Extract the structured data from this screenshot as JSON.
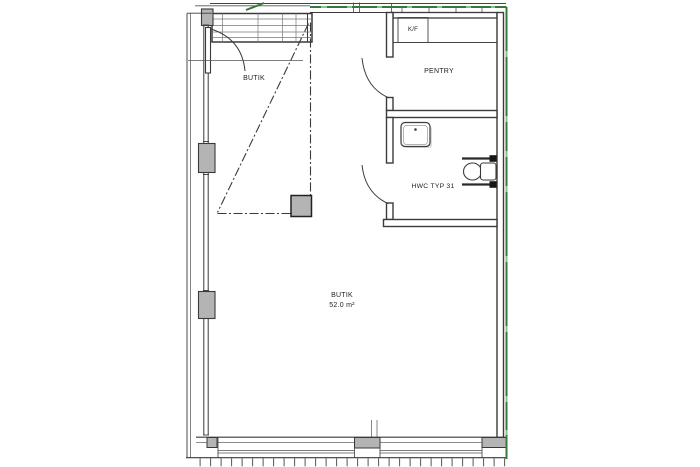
{
  "plan": {
    "type": "architectural-floor-plan",
    "entry_door_label": "BUTIK",
    "main_room": {
      "name": "BUTIK",
      "area": "52.0 m²"
    },
    "pentry": {
      "name": "PENTRY"
    },
    "hwc": {
      "name": "HWC TYP 31"
    },
    "appliance_label": "K/F",
    "colors": {
      "facade_green": "#357a38",
      "facade_green_light": "#8fc08b",
      "line_dark": "#3a3a3a",
      "line_light": "#6a6a6a",
      "fill_gray": "#b4b4b4"
    }
  }
}
